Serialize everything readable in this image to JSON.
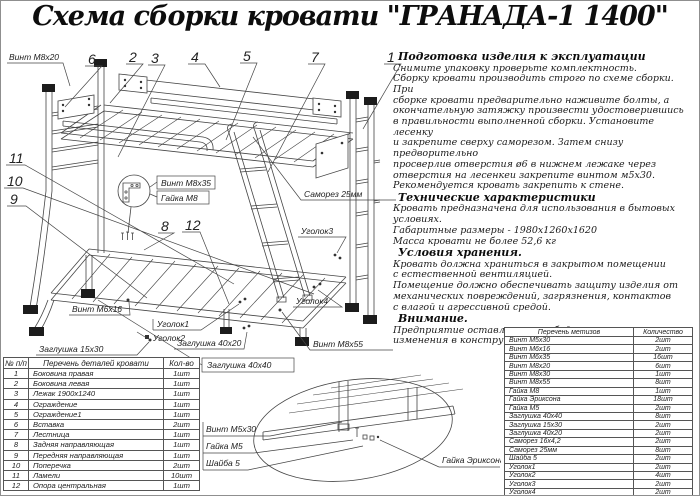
{
  "title": "Схема сборки кровати \"ГРАНАДА-1 1400\"",
  "instructions": {
    "prep": {
      "heading": "Подготовка изделия к эксплуатации",
      "lines": [
        "Снимите упаковку проверьте комплектность.",
        "Сборку кровати производить строго по схеме сборки. При",
        "сборке кровати  предварительно наживите  болты, а",
        "окончательную затяжку произвести удостоверившись",
        "в правильности выполненной сборки. Установите лесенку",
        "и закрепите сверху саморезом. Затем снизу предворительно",
        "просверлив отверстия ø6 в нижнем лежаке через",
        "отверстия на лесенкеи закрепите винтом м5х30.",
        "Рекомендуется кровать закрепить к стене."
      ]
    },
    "specs": {
      "heading": "Технические характеристики",
      "lines": [
        "Кровать предназначена для использования в бытовых",
        "условиях.",
        "Габаритные размеры - 1980х1260х1620",
        "Масса кровати не более 52,6 кг"
      ]
    },
    "storage": {
      "heading": "Условия хранения.",
      "lines": [
        "Кровать должна храниться в закрытом помещении",
        "с естественной вентиляцией.",
        "Помещение должно обеспечивать защиту изделия от",
        "механических повреждений, загрязнения, контактов",
        "с влагой и агрессивной средой."
      ]
    },
    "attention": {
      "heading": "Внимание.",
      "lines": [
        "Предприятие оставляет за собой права вносить",
        "изменения в конструкцию кроватей."
      ]
    }
  },
  "parts_table": {
    "headers": [
      "№ п/п",
      "Перечень деталей кровати",
      "Кол-во"
    ],
    "rows": [
      [
        "1",
        "Боковина правая",
        "1шт"
      ],
      [
        "2",
        "Боковина левая",
        "1шт"
      ],
      [
        "3",
        "Лежак 1900х1240",
        "1шт"
      ],
      [
        "4",
        "Ограждение",
        "1шт"
      ],
      [
        "5",
        "Ограждение1",
        "1шт"
      ],
      [
        "6",
        "Вставка",
        "2шт"
      ],
      [
        "7",
        "Лестница",
        "1шт"
      ],
      [
        "8",
        "Задняя направляющая",
        "1шт"
      ],
      [
        "9",
        "Передняя направляющая",
        "1шт"
      ],
      [
        "10",
        "Поперечка",
        "2шт"
      ],
      [
        "11",
        "Ламели",
        "10шт"
      ],
      [
        "12",
        "Опора центральная",
        "1шт"
      ]
    ]
  },
  "hardware_table": {
    "headers": [
      "Перечень метизов",
      "Количество"
    ],
    "rows": [
      [
        "Винт М5х30",
        "2шт"
      ],
      [
        "Винт М6х16",
        "2шт"
      ],
      [
        "Винт М6х35",
        "16шт"
      ],
      [
        "Винт М8х20",
        "6шт"
      ],
      [
        "Винт М8х30",
        "1шт"
      ],
      [
        "Винт М8х55",
        "8шт"
      ],
      [
        "Гайка М8",
        "1шт"
      ],
      [
        "Гайка Эриксона",
        "18шт"
      ],
      [
        "Гайка М5",
        "2шт"
      ],
      [
        "Заглушка 40х40",
        "8шт"
      ],
      [
        "Заглушка 15х30",
        "2шт"
      ],
      [
        "Заглушка 40х20",
        "2шт"
      ],
      [
        "Саморез 16х4,2",
        "2шт"
      ],
      [
        "Саморез 25мм",
        "8шт"
      ],
      [
        "Шайба 5",
        "2шт"
      ],
      [
        "Уголок1",
        "2шт"
      ],
      [
        "Уголок2",
        "4шт"
      ],
      [
        "Уголок3",
        "2шт"
      ],
      [
        "Уголок4",
        "2шт"
      ]
    ]
  },
  "diagram": {
    "callouts": {
      "n1": "1",
      "n2": "2",
      "n3": "3",
      "n4": "4",
      "n5": "5",
      "n6": "6",
      "n7": "7",
      "n8": "8",
      "n9": "9",
      "n10": "10",
      "n11": "11",
      "n12": "12"
    },
    "labels": {
      "vint_m8x20": "Винт М8х20",
      "vint_m8x35": "Винт М8х35",
      "gayka_m8": "Гайка М8",
      "samorez_25": "Саморез 25мм",
      "ugolok1": "Уголок1",
      "ugolok2": "Уголок2",
      "ugolok3": "Уголок3",
      "ugolok4": "Уголок4",
      "vint_m8x55": "Винт М8х55",
      "vint_m6x16": "Винт М6х16",
      "zaglushka_15x30": "Заглушка 15х30",
      "zaglushka_40x20": "Заглушка 40х20",
      "zaglushka_40x40": "Заглушка 40х40",
      "vint_m5x30": "Винт М5х30",
      "gayka_m5": "Гайка М5",
      "shayba_5": "Шайба 5",
      "gayka_eriksona": "Гайка Эриксона"
    }
  },
  "colors": {
    "ink": "#222222",
    "line": "#454545",
    "caps": "#1c1c1c"
  }
}
